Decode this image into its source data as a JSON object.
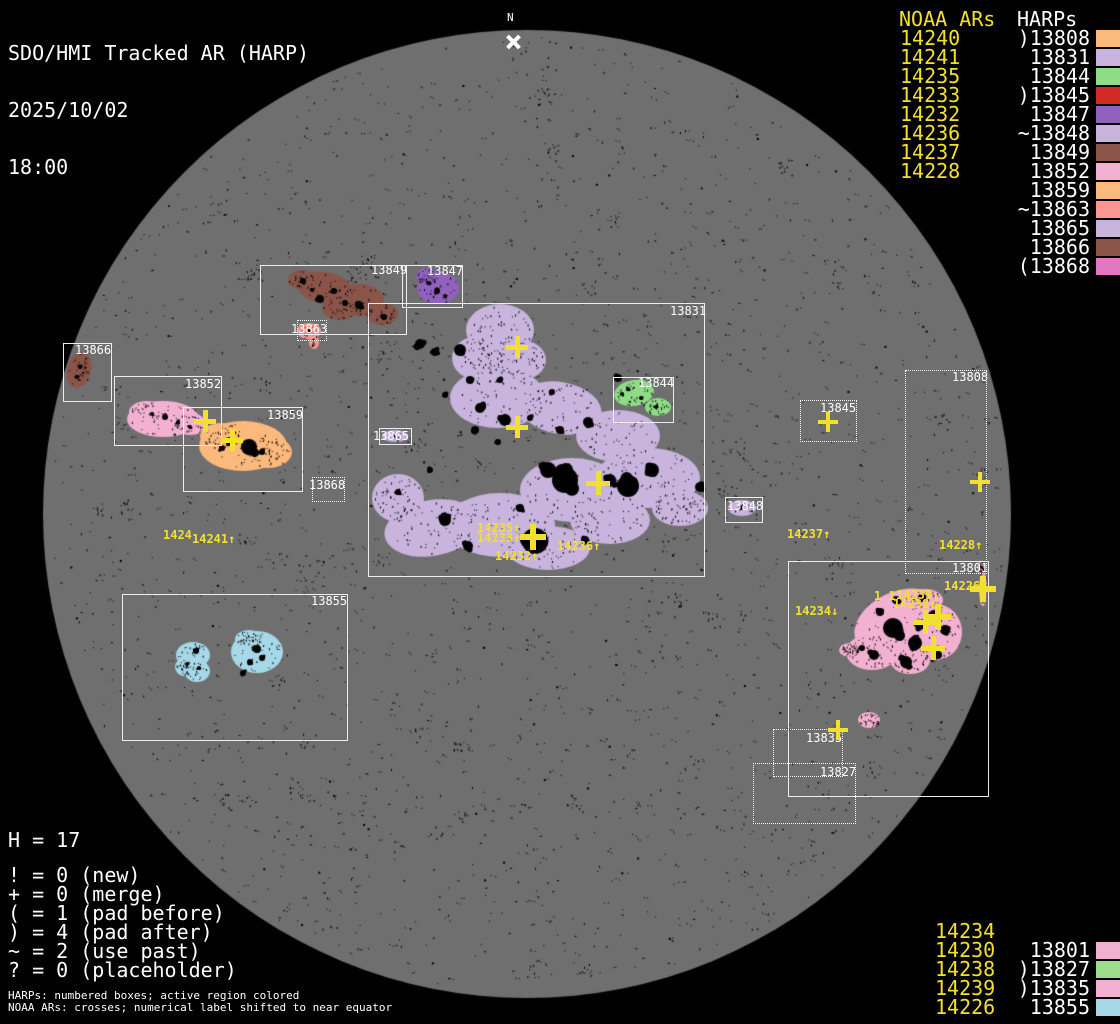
{
  "header": {
    "title": "SDO/HMI Tracked AR (HARP)",
    "date": "2025/10/02",
    "time": "18:00"
  },
  "north_marker": {
    "label": "N"
  },
  "colors": {
    "background": "#000000",
    "disk_gray": "#6F6F6F",
    "accent_yellow": "#F2E030",
    "label_white": "#FFFFFF"
  },
  "disk": {
    "cx": 527,
    "cy": 514,
    "r": 484,
    "color": "#6F6F6F"
  },
  "top_right_legend": {
    "noaa_header": "NOAA ARs",
    "harps_header": "HARPs",
    "noaa": [
      "14240",
      "14241",
      "14235",
      "14233",
      "14232",
      "14236",
      "14237",
      "14228"
    ],
    "harps": [
      {
        "text": ")13808",
        "color": "#FBB97C"
      },
      {
        "text": "13831",
        "color": "#C8B4DC"
      },
      {
        "text": "13844",
        "color": "#8FDC87"
      },
      {
        "text": ")13845",
        "color": "#D32A28"
      },
      {
        "text": "13847",
        "color": "#9161BE"
      },
      {
        "text": "~13848",
        "color": "#C8B4DC"
      },
      {
        "text": "13849",
        "color": "#8A5449"
      },
      {
        "text": "13852",
        "color": "#F3B1D2"
      },
      {
        "text": "13859",
        "color": "#FBB97C"
      },
      {
        "text": "~13863",
        "color": "#FB9693"
      },
      {
        "text": "13865",
        "color": "#C8B4DC"
      },
      {
        "text": "13866",
        "color": "#8A5449"
      },
      {
        "text": "(13868",
        "color": "#E377C2"
      }
    ]
  },
  "bottom_right_legend": {
    "noaa": [
      "14234",
      "14230",
      "14238",
      "14239",
      "14226"
    ],
    "harps": [
      {
        "text": "13801",
        "color": "#F3B1D2"
      },
      {
        "text": ")13827",
        "color": "#9CDC8C"
      },
      {
        "text": ")13835",
        "color": "#F3B1D2"
      },
      {
        "text": "13855",
        "color": "#A6D8E7"
      }
    ]
  },
  "stats": {
    "h_line": "H = 17",
    "lines": [
      "! = 0 (new)",
      "+ = 0 (merge)",
      "( = 1 (pad before)",
      ") = 4 (pad after)",
      "~ = 2 (use past)",
      "? = 0 (placeholder)"
    ]
  },
  "footnotes": [
    "HARPs: numbered boxes; active region colored",
    "NOAA ARs: crosses; numerical label shifted to near equator"
  ],
  "harp_boxes": [
    {
      "id": "13849",
      "x": 260,
      "y": 265,
      "w": 147,
      "h": 70,
      "style": "solid",
      "label": "13849",
      "lx": 371,
      "ly": 264
    },
    {
      "id": "13847",
      "x": 402,
      "y": 265,
      "w": 61,
      "h": 43,
      "style": "solid",
      "label": "13847",
      "lx": 427,
      "ly": 265
    },
    {
      "id": "13863",
      "x": 297,
      "y": 320,
      "w": 30,
      "h": 21,
      "style": "dotted",
      "label": "13863",
      "lx": 291,
      "ly": 323
    },
    {
      "id": "13831",
      "x": 368,
      "y": 303,
      "w": 337,
      "h": 274,
      "style": "solid",
      "label": "13831",
      "lx": 670,
      "ly": 305
    },
    {
      "id": "13844",
      "x": 613,
      "y": 377,
      "w": 61,
      "h": 46,
      "style": "solid",
      "label": "13844",
      "lx": 638,
      "ly": 377
    },
    {
      "id": "13865",
      "x": 379,
      "y": 428,
      "w": 33,
      "h": 17,
      "style": "solid",
      "label": "13865",
      "lx": 373,
      "ly": 430
    },
    {
      "id": "13866",
      "x": 63,
      "y": 343,
      "w": 49,
      "h": 59,
      "style": "solid",
      "label": "13866",
      "lx": 75,
      "ly": 344
    },
    {
      "id": "13852",
      "x": 114,
      "y": 376,
      "w": 108,
      "h": 70,
      "style": "solid",
      "label": "13852",
      "lx": 185,
      "ly": 378
    },
    {
      "id": "13859",
      "x": 183,
      "y": 407,
      "w": 120,
      "h": 85,
      "style": "solid",
      "label": "13859",
      "lx": 267,
      "ly": 409
    },
    {
      "id": "13868",
      "x": 312,
      "y": 477,
      "w": 33,
      "h": 25,
      "style": "dotted",
      "label": "13868",
      "lx": 309,
      "ly": 479
    },
    {
      "id": "13855",
      "x": 122,
      "y": 594,
      "w": 226,
      "h": 147,
      "style": "solid",
      "label": "13855",
      "lx": 311,
      "ly": 595
    },
    {
      "id": "13845",
      "x": 800,
      "y": 400,
      "w": 57,
      "h": 42,
      "style": "dotted",
      "label": "13845",
      "lx": 820,
      "ly": 402
    },
    {
      "id": "13808",
      "x": 905,
      "y": 370,
      "w": 82,
      "h": 204,
      "style": "dotted",
      "label": "13808",
      "lx": 952,
      "ly": 371
    },
    {
      "id": "13848",
      "x": 725,
      "y": 497,
      "w": 38,
      "h": 26,
      "style": "solid",
      "label": "13848",
      "lx": 727,
      "ly": 500
    },
    {
      "id": "13801",
      "x": 788,
      "y": 561,
      "w": 201,
      "h": 236,
      "style": "solid",
      "label": "13801",
      "lx": 952,
      "ly": 562
    },
    {
      "id": "13835",
      "x": 773,
      "y": 729,
      "w": 70,
      "h": 48,
      "style": "dotted",
      "label": "13835",
      "lx": 806,
      "ly": 732
    },
    {
      "id": "13827",
      "x": 753,
      "y": 763,
      "w": 103,
      "h": 61,
      "style": "dotted",
      "label": "13827",
      "lx": 820,
      "ly": 766
    }
  ],
  "noaa_crosses": [
    [
      517,
      347,
      22
    ],
    [
      517,
      427,
      22
    ],
    [
      598,
      483,
      24
    ],
    [
      533,
      537,
      26
    ],
    [
      205,
      421,
      22
    ],
    [
      232,
      440,
      22
    ],
    [
      828,
      422,
      20
    ],
    [
      980,
      482,
      20
    ],
    [
      925,
      622,
      24
    ],
    [
      938,
      617,
      26
    ],
    [
      933,
      648,
      24
    ],
    [
      983,
      589,
      26
    ],
    [
      838,
      730,
      20
    ]
  ],
  "noaa_shifted_labels": [
    {
      "text": "1424",
      "x": 163,
      "y": 529
    },
    {
      "text": "14241↑",
      "x": 192,
      "y": 533
    },
    {
      "text": "14235↑",
      "x": 477,
      "y": 522
    },
    {
      "text": "14233↑",
      "x": 477,
      "y": 532
    },
    {
      "text": "14232↑",
      "x": 495,
      "y": 550
    },
    {
      "text": "14236↑",
      "x": 557,
      "y": 540
    },
    {
      "text": "14237↑",
      "x": 787,
      "y": 528
    },
    {
      "text": "14228↑",
      "x": 939,
      "y": 539
    },
    {
      "text": "14234↓",
      "x": 795,
      "y": 605
    },
    {
      "text": "1 1",
      "x": 874,
      "y": 590
    },
    {
      "text": "14239↓",
      "x": 896,
      "y": 589
    },
    {
      "text": "14238↓",
      "x": 893,
      "y": 598
    },
    {
      "text": "14226",
      "x": 944,
      "y": 580
    }
  ],
  "regions": [
    {
      "name": "ar-13831",
      "color": "#C8B4DC",
      "speckles": 780,
      "ellipses": [
        [
          500,
          330,
          34,
          26,
          0
        ],
        [
          478,
          358,
          26,
          22,
          0
        ],
        [
          520,
          360,
          26,
          20,
          0
        ],
        [
          498,
          398,
          48,
          30,
          0
        ],
        [
          560,
          408,
          42,
          26,
          10
        ],
        [
          618,
          436,
          42,
          26,
          0
        ],
        [
          648,
          478,
          52,
          30,
          0
        ],
        [
          572,
          490,
          52,
          32,
          0
        ],
        [
          500,
          525,
          55,
          32,
          0
        ],
        [
          432,
          528,
          48,
          28,
          -10
        ],
        [
          398,
          498,
          26,
          24,
          0
        ],
        [
          548,
          548,
          42,
          22,
          0
        ],
        [
          680,
          508,
          28,
          18,
          0
        ],
        [
          610,
          520,
          40,
          24,
          0
        ]
      ],
      "spots": [
        [
          565,
          480,
          13
        ],
        [
          628,
          486,
          11
        ],
        [
          535,
          541,
          13
        ],
        [
          548,
          470,
          8
        ],
        [
          610,
          480,
          6
        ],
        [
          652,
          470,
          7
        ],
        [
          700,
          487,
          5
        ],
        [
          505,
          420,
          6
        ],
        [
          480,
          408,
          5
        ],
        [
          460,
          350,
          6
        ],
        [
          420,
          344,
          5
        ],
        [
          435,
          352,
          4
        ],
        [
          588,
          422,
          5
        ],
        [
          560,
          430,
          4
        ],
        [
          618,
          378,
          4
        ],
        [
          640,
          390,
          3
        ],
        [
          445,
          520,
          6
        ],
        [
          468,
          546,
          5
        ],
        [
          520,
          508,
          4
        ],
        [
          398,
          492,
          3
        ],
        [
          430,
          470,
          3
        ],
        [
          585,
          540,
          4
        ],
        [
          475,
          430,
          4
        ],
        [
          498,
          442,
          3
        ],
        [
          530,
          418,
          3
        ],
        [
          552,
          392,
          3
        ],
        [
          500,
          380,
          3
        ],
        [
          470,
          380,
          4
        ],
        [
          445,
          395,
          3
        ]
      ]
    },
    {
      "name": "ar-13849",
      "color": "#8A5449",
      "speckles": 120,
      "ellipses": [
        [
          325,
          288,
          28,
          16,
          10
        ],
        [
          358,
          300,
          26,
          16,
          0
        ],
        [
          302,
          280,
          14,
          10,
          0
        ],
        [
          382,
          314,
          16,
          11,
          0
        ],
        [
          340,
          308,
          18,
          12,
          0
        ]
      ],
      "spots": [
        [
          320,
          299,
          4
        ],
        [
          334,
          291,
          3
        ],
        [
          359,
          305,
          4
        ],
        [
          303,
          281,
          3
        ],
        [
          384,
          317,
          3
        ],
        [
          345,
          303,
          3
        ],
        [
          312,
          290,
          2
        ]
      ]
    },
    {
      "name": "ar-13847",
      "color": "#9161BE",
      "speckles": 55,
      "ellipses": [
        [
          438,
          288,
          21,
          16,
          0
        ],
        [
          427,
          276,
          11,
          8,
          0
        ]
      ],
      "spots": [
        [
          437,
          291,
          3
        ],
        [
          429,
          283,
          2
        ],
        [
          445,
          296,
          2
        ]
      ]
    },
    {
      "name": "ar-13863",
      "color": "#FB9693",
      "speckles": 16,
      "ellipses": [
        [
          309,
          331,
          12,
          8,
          0
        ],
        [
          314,
          342,
          5,
          7,
          0
        ]
      ],
      "spots": [
        [
          309,
          331,
          2
        ],
        [
          313,
          340,
          1
        ]
      ]
    },
    {
      "name": "ar-13866",
      "color": "#8A5449",
      "speckles": 28,
      "ellipses": [
        [
          79,
          370,
          12,
          18,
          15
        ]
      ],
      "spots": [
        [
          80,
          367,
          2
        ],
        [
          77,
          377,
          2
        ],
        [
          83,
          373,
          1
        ]
      ]
    },
    {
      "name": "ar-13852",
      "color": "#F3B1D2",
      "speckles": 95,
      "ellipses": [
        [
          163,
          419,
          36,
          18,
          0
        ],
        [
          147,
          412,
          18,
          11,
          0
        ],
        [
          190,
          424,
          16,
          11,
          0
        ]
      ],
      "spots": [
        [
          165,
          417,
          3
        ],
        [
          152,
          414,
          2
        ],
        [
          178,
          422,
          2
        ],
        [
          190,
          427,
          2
        ]
      ]
    },
    {
      "name": "ar-13859",
      "color": "#FBB97C",
      "speckles": 120,
      "ellipses": [
        [
          243,
          446,
          44,
          25,
          0
        ],
        [
          222,
          436,
          22,
          13,
          0
        ],
        [
          268,
          452,
          24,
          16,
          0
        ]
      ],
      "spots": [
        [
          249,
          447,
          8
        ],
        [
          231,
          441,
          4
        ],
        [
          222,
          448,
          3
        ],
        [
          262,
          452,
          3
        ]
      ]
    },
    {
      "name": "ar-13865",
      "color": "#C8B4DC",
      "speckles": 8,
      "ellipses": [
        [
          395,
          436,
          13,
          6,
          0
        ]
      ],
      "spots": [
        [
          394,
          436,
          1
        ]
      ]
    },
    {
      "name": "ar-13844",
      "color": "#8FDC87",
      "speckles": 60,
      "ellipses": [
        [
          634,
          393,
          20,
          13,
          -10
        ],
        [
          658,
          407,
          13,
          9,
          0
        ]
      ],
      "spots": [
        [
          628,
          389,
          2
        ],
        [
          641,
          398,
          2
        ],
        [
          656,
          407,
          2
        ],
        [
          622,
          394,
          2
        ]
      ]
    },
    {
      "name": "ar-13848",
      "color": "#C8B4DC",
      "speckles": 10,
      "ellipses": [
        [
          742,
          508,
          14,
          8,
          0
        ]
      ],
      "spots": [
        [
          741,
          508,
          2
        ]
      ]
    },
    {
      "name": "ar-13855",
      "color": "#A6D8E7",
      "speckles": 130,
      "ellipses": [
        [
          193,
          655,
          17,
          13,
          0
        ],
        [
          197,
          671,
          13,
          11,
          0
        ],
        [
          184,
          667,
          9,
          9,
          0
        ],
        [
          257,
          652,
          26,
          21,
          0
        ],
        [
          249,
          639,
          14,
          9,
          0
        ]
      ],
      "spots": [
        [
          257,
          649,
          4
        ],
        [
          250,
          662,
          3
        ],
        [
          243,
          673,
          3
        ],
        [
          196,
          651,
          3
        ],
        [
          199,
          668,
          2
        ],
        [
          187,
          664,
          2
        ],
        [
          262,
          658,
          3
        ]
      ]
    },
    {
      "name": "ar-13801",
      "color": "#F3B1D2",
      "speckles": 360,
      "ellipses": [
        [
          898,
          622,
          46,
          30,
          -25
        ],
        [
          936,
          632,
          26,
          28,
          0
        ],
        [
          872,
          652,
          26,
          18,
          0
        ],
        [
          850,
          650,
          11,
          7,
          0
        ],
        [
          925,
          600,
          18,
          11,
          0
        ],
        [
          910,
          660,
          20,
          14,
          0
        ],
        [
          869,
          720,
          11,
          8,
          0
        ],
        [
          983,
          589,
          4,
          17,
          0
        ],
        [
          981,
          568,
          3,
          7,
          0
        ]
      ],
      "spots": [
        [
          893,
          628,
          10
        ],
        [
          915,
          643,
          7
        ],
        [
          934,
          616,
          6
        ],
        [
          906,
          662,
          6
        ],
        [
          874,
          655,
          5
        ],
        [
          922,
          598,
          4
        ],
        [
          880,
          612,
          4
        ],
        [
          945,
          630,
          5
        ],
        [
          896,
          600,
          4
        ],
        [
          862,
          648,
          3
        ],
        [
          938,
          655,
          4
        ],
        [
          920,
          625,
          5
        ]
      ]
    }
  ]
}
